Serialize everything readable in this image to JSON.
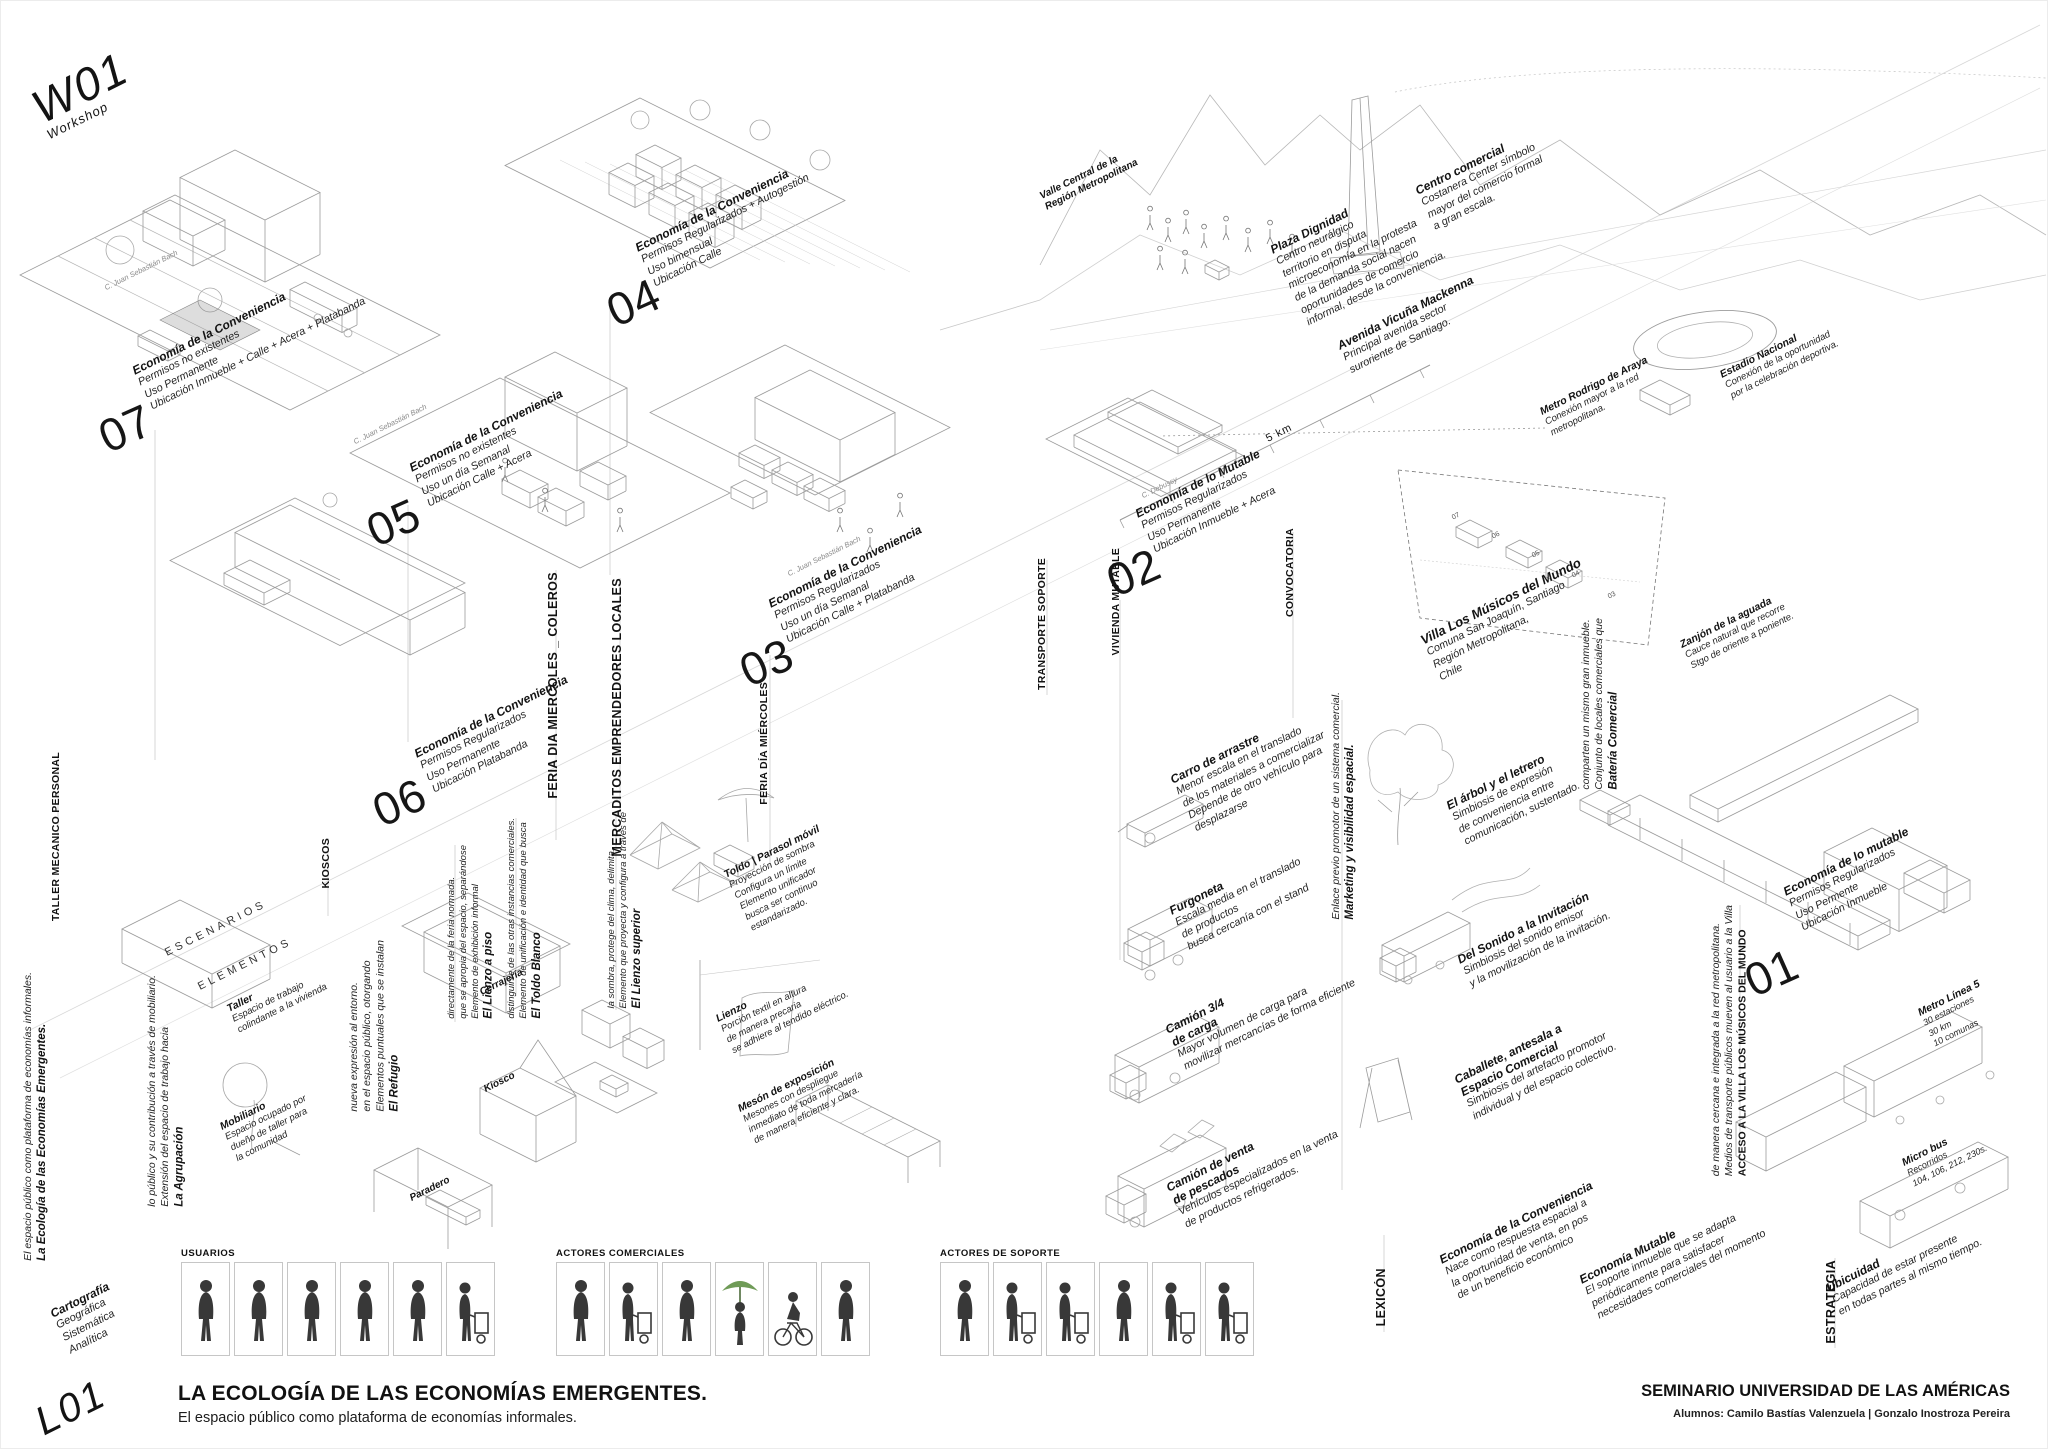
{
  "poster": {
    "workshop": {
      "code": "W01",
      "label": "Workshop"
    },
    "cartography": {
      "title": "Cartografía",
      "lines": "Geográfica\nSistemática\nAnalítica",
      "code": "L01"
    },
    "side_title": {
      "title": "La Ecología de las Economías Emergentes.",
      "body": "El espacio público como plataforma de economías informales."
    },
    "footer": {
      "title": "LA ECOLOGÍA DE LAS ECONOMÍAS EMERGENTES.",
      "subtitle": "El espacio público como plataforma de economías informales.",
      "seminar": "SEMINARIO UNIVERSIDAD DE LAS AMÉRICAS",
      "students": "Alumnos: Camilo Bastías Valenzuela | Gonzalo Inostroza Pereira"
    }
  },
  "scenarios": {
    "s07": {
      "number": "07",
      "title": "Economía de la Conveniencia",
      "body": "Permisos no existentes\nUso Permanente\nUbicación Inmueble + Calle + Acera + Platabanda"
    },
    "s05": {
      "number": "05",
      "title": "Economía de la Conveniencia",
      "body": "Permisos no existentes\nUso un día Semanal\nUbicación Calle + Acera"
    },
    "s06": {
      "number": "06",
      "title": "Economía de la Conveniencia",
      "body": "Permisos Regularizados\nUso Permanente\nUbicación Platabanda"
    },
    "s04": {
      "number": "04",
      "title": "Economía de la Conveniencia",
      "body": "Permisos Regularizados + Autogestión\nUso bimensual\nUbicación Calle"
    },
    "s03": {
      "number": "03",
      "title": "Economía de la Conveniencia",
      "body": "Permisos Regularizados\nUso un día Semanal\nUbicación Calle + Platabanda"
    },
    "s02": {
      "number": "02",
      "title": "Economía de lo Mutable",
      "body": "Permisos Regularizados\nUso Permanente\nUbicación Inmueble + Acera"
    },
    "s01": {
      "number": "01",
      "title": "Economía de lo mutable",
      "body": "Permisos Regularizados\nUso Permente\nUbicación Inmueble"
    }
  },
  "axes": {
    "taller_mecanico": "TALLER MECANICO PERSONAL",
    "kioscos": "KIOSCOS",
    "feria_coleros": "FERIA DIA MIERCOLES _ COLEROS",
    "mercaditos": "MERCADITOS EMPRENDEDORES LOCALES",
    "feria_miercoles": "FERIA DÍA MIÉRCOLES",
    "transporte": "TRANSPORTE SOPORTE",
    "vivienda": "VIVIENDA MUTABLE",
    "convocatoria": "CONVOCATORIA",
    "lexicon": "LEXICÓN",
    "estrategia": "ESTRATEGIA",
    "escenarios": "ESCENARIOS",
    "elementos": "ELEMENTOS",
    "acceso": {
      "title": "ACCESO A LA VILLA LOS MÚSICOS DEL MUNDO",
      "body": "Medios de transporte públicos mueven al usuario a la Villa\nde manera cercana e integrada a la red metropolitana."
    },
    "marketing": {
      "title": "Marketing y visibilidad espacial.",
      "body": "Enlace previo promotor de un sistema comercial."
    }
  },
  "map": {
    "valle": {
      "title": "Valle Central de la\nRegión Metropolitana",
      "body": ""
    },
    "centro": {
      "title": "Centro comercial",
      "body": "Costanera Center símbolo\nmayor del comercio formal\na gran escala."
    },
    "plaza": {
      "title": "Plaza Dignidad",
      "body": "Centro neurálgico\nterritorio en disputa\nmicroeconomía en la protesta\nde la demanda social nacen\noportunidades de comercio\ninformal, desde la conveniencia."
    },
    "avenida": {
      "title": "Avenida Vicuña Mackenna",
      "body": "Principal avenida sector\nsuroriente de Santiago."
    },
    "metro_araya": {
      "title": "Metro Rodrigo de Araya",
      "body": "Conexión mayor a la red\nmetropolitana."
    },
    "estadio": {
      "title": "Estadio Nacional",
      "body": "Conexión de la oportunidad\npor la celebración deportiva."
    },
    "villa": {
      "title": "Villa Los Músicos del Mundo",
      "body": "Comuna San Joaquín, Santiago\nRegión Metropolitana,\nChile"
    },
    "bateria": {
      "title": "Batería Comercial",
      "body": "Conjunto de locales comerciales que\ncomparten un mismo gran inmueble."
    },
    "zanjon": {
      "title": "Zanjón de la aguada",
      "body": "Cauce natural que recorre\nStgo de oriente a poniente."
    }
  },
  "scale_label": "5 km",
  "streets": {
    "bach": "C. Juan Sebastián Bach",
    "debussy": "C. Debussy"
  },
  "villa_markers": {
    "m1": "07",
    "m2": "06",
    "m3": "05",
    "m4": "04",
    "m5": "03"
  },
  "elements": {
    "taller": {
      "title": "Taller",
      "body": "Espacio de trabajo\ncolindante a la vivienda"
    },
    "mobiliario": {
      "title": "Mobiliario",
      "body": "Espacio ocupado por\ndueño de taller para\nla comunidad"
    },
    "agrupacion": {
      "title": "La Agrupación",
      "body": "Extensión del espacio de trabajo hacia\nlo público y su contribución a través de mobiliario."
    },
    "refugio": {
      "title": "El Refugio",
      "body": "Elementos puntuales que se instalan\nen el espacio público, otorgando\nnueva expresión al entorno."
    },
    "cerrajeria": {
      "title": "Cerrajería"
    },
    "kiosco": {
      "title": "Kiosco"
    },
    "paradero": {
      "title": "Paradero"
    },
    "lienzo_piso": {
      "title": "El Lienzo a piso",
      "body": "Elemento de exhibición informal\nque se apropia del espacio, separándose\ndirectamente de la feria normada."
    },
    "toldo_blanco": {
      "title": "El Toldo Blanco",
      "body": "Elemento de unificación e identidad que busca\ndistinguirse de las otras instancias comerciales."
    },
    "lienzo_superior": {
      "title": "El Lienzo superior",
      "body": "Elemento que proyecta y configura a través de\nla sombra, protege del clima, delimita."
    },
    "toldo_parasol": {
      "title": "Toldo | Parasol móvil",
      "body": "Proyección de sombra\nConfigura un límite\nElemento unificador\nbusca ser continuo\nestandarizado."
    },
    "lienzo": {
      "title": "Lienzo",
      "body": "Porción textil en altura\nde manera precaria\nse adhiere al tendido eléctrico."
    },
    "meson": {
      "title": "Mesón de exposición",
      "body": "Mesones con despliegue\ninmediato de toda mercadería\nde manera eficiente y clara."
    }
  },
  "vehicles": {
    "carro": {
      "title": "Carro de arrastre",
      "body": "Menor escala en el translado\nde los materiales a comercializar\nDepende de otro vehículo para\ndesplazarse"
    },
    "furgoneta": {
      "title": "Furgoneta",
      "body": "Escala media en el translado\nde productos\nbusca cercanía con el stand"
    },
    "camion34": {
      "title": "Camión 3/4\nde carga",
      "body": "Mayor volumen de carga para\nmovilizar mercancías de forma eficiente"
    },
    "pescados": {
      "title": "Camión de venta\nde pescados",
      "body": "Vehículos especializados en la venta\nde productos refrigerados."
    },
    "arbol": {
      "title": "El árbol y el letrero",
      "body": "Simbiosis de expresión\nde conveniencia entre\ncomunicación, sustentado."
    },
    "sonido": {
      "title": "Del Sonido a la Invitación",
      "body": "Simbiosis del sonido emisor\ny la movilización de la invitación."
    },
    "caballete": {
      "title": "Caballete, antesala a\nEspacio Comercial",
      "body": "Simbiosis del artefacto promotor\nindividual y del espacio colectivo."
    }
  },
  "transport": {
    "metro5": {
      "title": "Metro Línea 5",
      "body": "30 estaciones\n30 km\n10 comunas"
    },
    "micro": {
      "title": "Micro bus",
      "body": "Recorridos\n104, 106, 212, 230s."
    }
  },
  "lexicon": {
    "conveniencia": {
      "title": "Economía de la Conveniencia",
      "body": "Nace como respuesta espacial a\nla oportunidad de venta, en pos\nde un beneficio económico"
    },
    "mutable": {
      "title": "Economía Mutable",
      "body": "El soporte inmueble que se adapta\nperiódicamente para satisfacer\nnecesidades comerciales del momento"
    },
    "ubicuidad": {
      "title": "Ubicuidad",
      "body": "Capacidad de estar presente\nen todas partes al mismo tiempo."
    }
  },
  "strips": {
    "usuarios": "USUARIOS",
    "comerciales": "ACTORES COMERCIALES",
    "soporte": "ACTORES DE SOPORTE"
  },
  "colors": {
    "ink": "#111111",
    "lineart": "#9c9c9c",
    "accent_green": "#6f9b57"
  }
}
